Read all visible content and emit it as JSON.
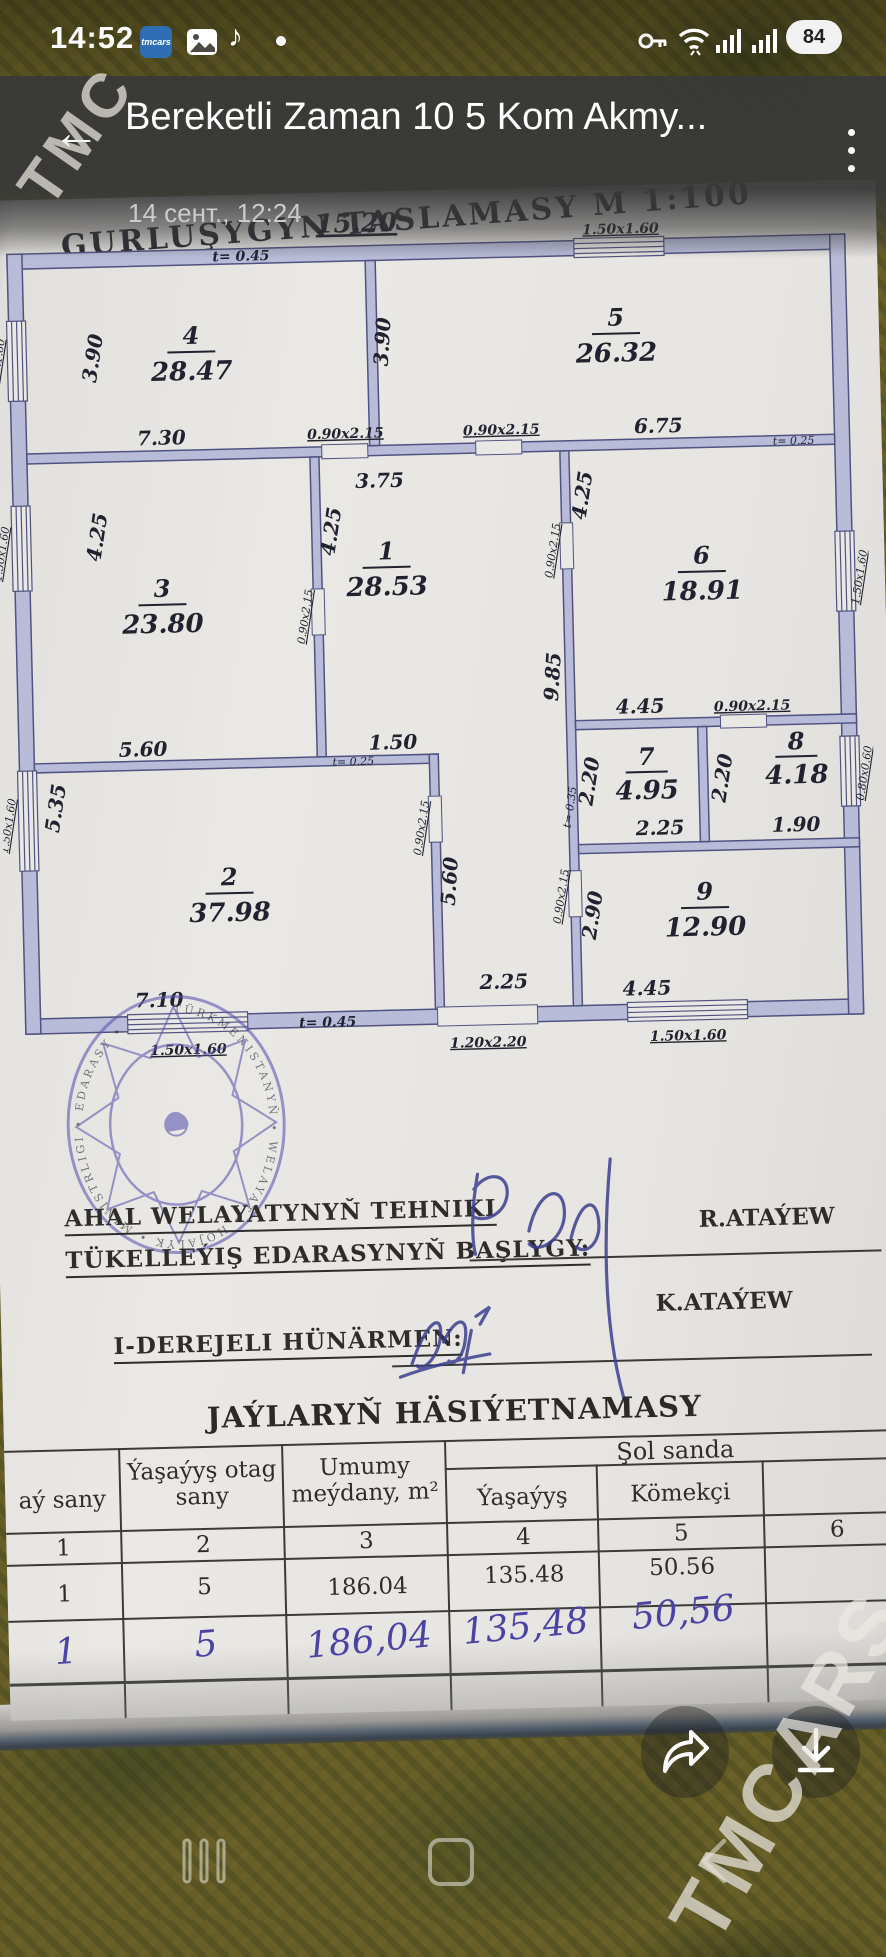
{
  "colors": {
    "wall_fill": "#b8bcd8",
    "wall_line": "#4f5380",
    "ink_blue": "#4a43a6",
    "paper": "#e7e5e2",
    "header_bar": "#383838",
    "app_blue": "#2e6fb4"
  },
  "status_bar": {
    "time": "14:52",
    "app_icon_label": "tmcars",
    "battery_percent": "84"
  },
  "header": {
    "title": "Bereketli Zaman 10 5 Kom Akmy...",
    "subtitle": "14 сент., 12:24"
  },
  "watermarks": {
    "top_left": "TMC",
    "bottom_right": "TMCARS"
  },
  "document": {
    "heading": "GURLUŞYGYN TASLAMASY  M 1:100",
    "officials": {
      "line1": "AHAL WELAYATYNYŇ  TEHNIKI",
      "line2": "TÜKELLEÝIŞ EDARASYNYŇ BAŞLYGY:",
      "name1": "R.ATAÝEW",
      "line3": "I-DEREJELI HÜNÄRMEN:",
      "name2": "K.ATAÝEW"
    },
    "stamp_text": "TÜRKMENISTANYŇ • WELAYAT • HOJALYK • MINISTRLIGI • EDARASY •",
    "table_title": "JAÝLARYŇ HÄSIÝETNAMASY",
    "table": {
      "col1": "aý sany",
      "col2": "Ýaşaýyş otag sany",
      "col3": "Umumy meýdany, m²",
      "span": "Şol sanda",
      "col4": "Ýaşaýyş",
      "col5": "Kömekçi",
      "number_row": [
        "1",
        "2",
        "3",
        "4",
        "5",
        "6"
      ],
      "printed_row": [
        "1",
        "5",
        "186.04",
        "135.48",
        "50.56",
        ""
      ],
      "written_row": [
        "1",
        "5",
        "186,04",
        "135,48",
        "50,56",
        ""
      ]
    }
  },
  "plan": {
    "overall_width": "15.20",
    "rooms": [
      {
        "n": "4",
        "a": "28.47"
      },
      {
        "n": "5",
        "a": "26.32"
      },
      {
        "n": "3",
        "a": "23.80"
      },
      {
        "n": "1",
        "a": "28.53"
      },
      {
        "n": "6",
        "a": "18.91"
      },
      {
        "n": "7",
        "a": "4.95"
      },
      {
        "n": "8",
        "a": "4.18"
      },
      {
        "n": "9",
        "a": "12.90"
      },
      {
        "n": "2",
        "a": "37.98"
      }
    ],
    "labels": {
      "t_top": "t= 0.45",
      "win_top": "1.50x1.60",
      "r4_h": "3.90",
      "r4_w": "7.30",
      "win_l1": "1.50x1.60",
      "d45": "3.90",
      "r5_w": "6.75",
      "doorA1": "0.90x2.15",
      "doorA2": "0.90x2.15",
      "r1_top": "3.75",
      "r1_h": "4.25",
      "r1_150": "1.50",
      "r3_h": "4.25",
      "r3_w": "5.60",
      "win_l2": "1.50x1.60",
      "d3h": "0.90x2.15",
      "r6_h": "4.25",
      "r6_w": "4.45",
      "r6_win": "1.50x1.60",
      "d6b": "0.90x2.15",
      "dRC1": "0.90x2.15",
      "dRC2": "0.90x2.15",
      "cor_len": "9.85",
      "cor_560": "5.60",
      "cor_225": "2.25",
      "t_a": "t= 0.25",
      "t_b": "t= 0.25",
      "t_c": "t= 0.35",
      "d2r": "0.90x2.15",
      "r2_h": "5.35",
      "r2_w": "7.10",
      "win_l3": "1.50x1.60",
      "r7_h": "2.20",
      "r7_w": "2.25",
      "r8_h": "2.20",
      "r8_w": "1.90",
      "r8_win": "0.80x0.60",
      "r9_h": "2.90",
      "r9_w": "4.45",
      "t_bot": "t= 0.45",
      "bw1": "1.50x1.60",
      "bw2": "1.20x2.20",
      "bw3": "1.50x1.60"
    }
  }
}
